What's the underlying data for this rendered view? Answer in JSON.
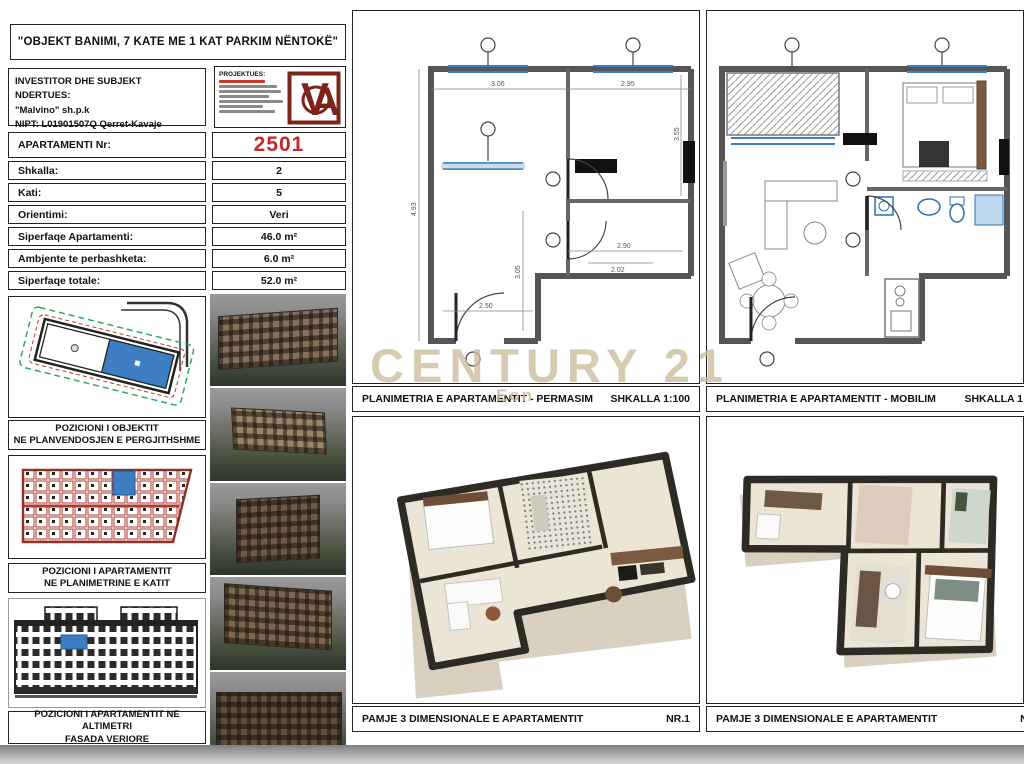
{
  "sheet": {
    "title": "\"OBJEKT BANIMI, 7 KATE ME 1 KAT PARKIM NËNTOKË\"",
    "investor": {
      "line1": "INVESTITOR DHE SUBJEKT NDERTUES:",
      "line2": "\"Malvino\" sh.p.k",
      "line3": "NIPT: L01901507Q  Qerret-Kavaje"
    },
    "designer_label": "PROJEKTUES:",
    "logo_letters": "VA"
  },
  "apartment_table": {
    "rows": [
      {
        "label": "APARTAMENTI Nr:",
        "value": "2501"
      },
      {
        "label": "Shkalla:",
        "value": "2"
      },
      {
        "label": "Kati:",
        "value": "5"
      },
      {
        "label": "Orientimi:",
        "value": "Veri"
      },
      {
        "label": "Siperfaqe Apartamenti:",
        "value": "46.0 m²"
      },
      {
        "label": "Ambjente te perbashketa:",
        "value": "6.0 m²"
      },
      {
        "label": "Siperfaqe totale:",
        "value": "52.0 m²"
      }
    ]
  },
  "captions": {
    "site_line1": "POZICIONI I OBJEKTIT",
    "site_line2": "NE PLANVENDOSJEN E PERGJITHSHME",
    "floor_line1": "POZICIONI I APARTAMENTIT",
    "floor_line2": "NE PLANIMETRINE E KATIT",
    "facade_line1": "POZICIONI I APARTAMENTIT NE ALTIMETRI",
    "facade_line2": "FASADA VERIORE"
  },
  "panels": {
    "plan_dim": {
      "title": "PLANIMETRIA E APARTAMENTIT - PERMASIM",
      "scale": "SHKALLA 1:100"
    },
    "plan_furn": {
      "title": "PLANIMETRIA E APARTAMENTIT - MOBILIM",
      "scale": "SHKALLA 1:100"
    },
    "view3d_1": {
      "title": "PAMJE 3 DIMENSIONALE E APARTAMENTIT",
      "number": "NR.1"
    },
    "view3d_2": {
      "title": "PAMJE 3 DIMENSIONALE E APARTAMENTIT",
      "number": "NR.2"
    }
  },
  "watermark": {
    "text": "CENTURY 21",
    "sub": "Eon"
  },
  "plan_dimensions": {
    "d1": "3.06",
    "d2": "2.95",
    "d3": "3.55",
    "d4": "2.90",
    "d5": "2.02",
    "d6": "2.50",
    "d7": "3.05",
    "d8": "4.93"
  },
  "colors": {
    "highlight_red": "#c12a28",
    "logo_red": "#7c241a",
    "apartment_blue": "#3d7ec2",
    "fixture_blue": "#2d6fb0",
    "watermark_tan": "#cbbc98"
  }
}
